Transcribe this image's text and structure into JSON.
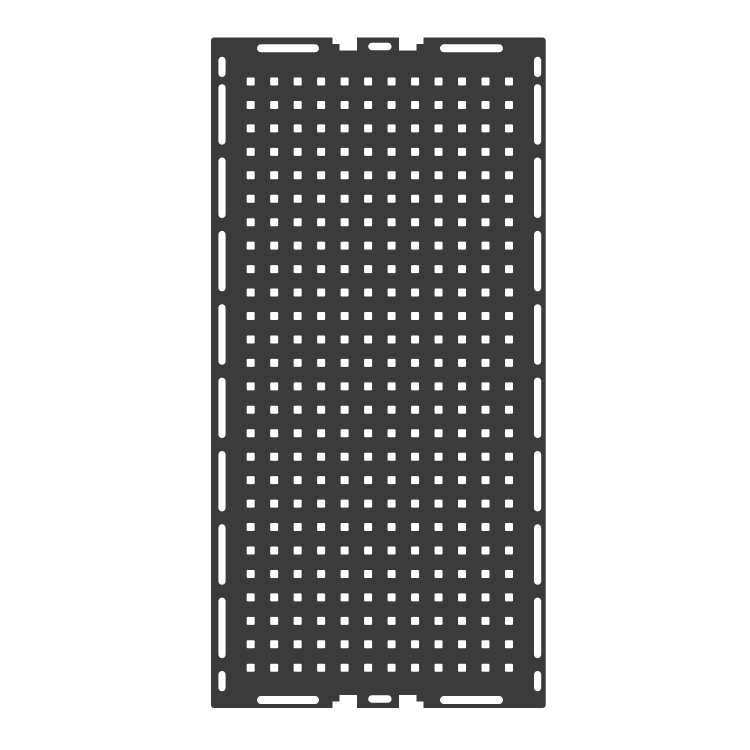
{
  "image": {
    "kind": "technical-cutout-drawing",
    "subject": "perforated-mounting-plate"
  },
  "canvas": {
    "width": 750,
    "height": 750
  },
  "colors": {
    "background": "#ffffff",
    "plate": "#3b3b3b",
    "cutout": "#ffffff"
  },
  "plate": {
    "x": 211,
    "y": 37.5,
    "width": 334.7,
    "height": 670.5,
    "corner_radius": 3
  },
  "hole_grid": {
    "columns": 12,
    "rows": 26,
    "start_x": 246.7,
    "start_y": 77.5,
    "pitch_x": 23.48,
    "pitch_y": 23.45,
    "hole_size": 8,
    "hole_corner_radius": 1
  },
  "side_slots": {
    "left_x": 218.4,
    "right_x": 534,
    "width": 7.2,
    "corner_radius": 3.6,
    "short_top": {
      "y": 56.8,
      "height": 20.3
    },
    "long": {
      "count": 8,
      "start_y": 84.2,
      "pitch": 73.35,
      "height": 60.5
    },
    "short_bottom": {
      "y": 671,
      "height": 20.3
    }
  },
  "corner_pill_slots": {
    "height": 8,
    "corner_radius": 4,
    "top_y": 44.3,
    "bottom_y": 696,
    "left_x": 257,
    "left_width": 62,
    "right_x": 440,
    "right_width": 63
  },
  "center_edge_features": {
    "notches": [
      {
        "x": 339.5,
        "width": 17.5
      },
      {
        "x": 399,
        "width": 17.5
      }
    ],
    "notch_depth": 13,
    "shoulder_recesses": [
      {
        "x": 332.5,
        "width": 7
      },
      {
        "x": 416.5,
        "width": 7
      }
    ],
    "recess_depth": 6.5,
    "pill": {
      "x": 368.2,
      "width": 23.4,
      "height": 7.6,
      "edge_inset": 5.2,
      "corner_radius": 3.8
    }
  }
}
